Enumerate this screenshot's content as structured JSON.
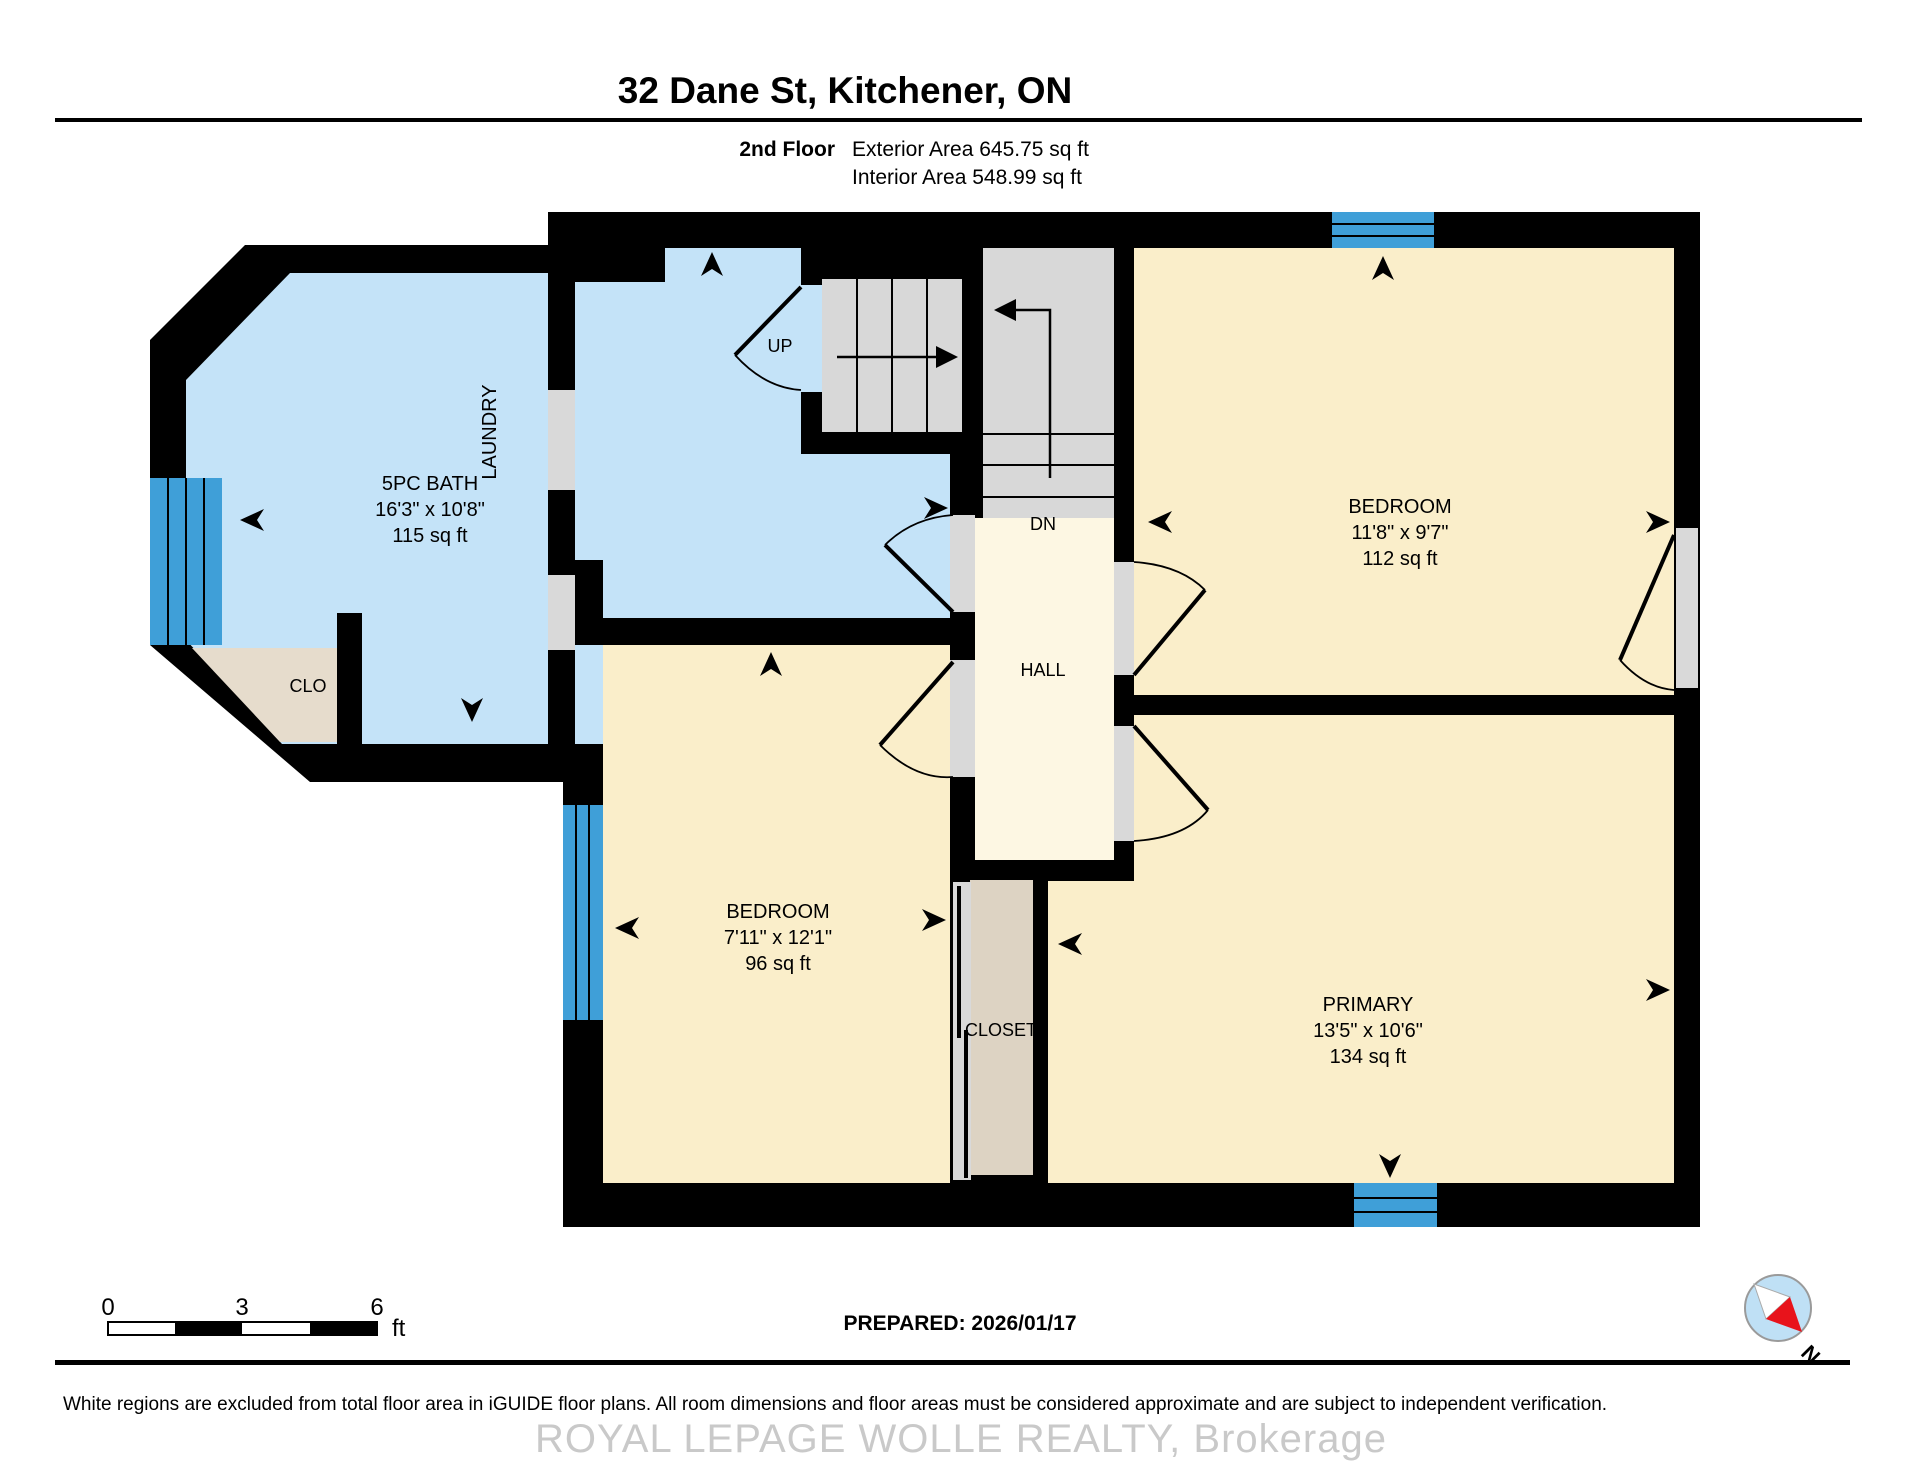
{
  "header": {
    "title": "32 Dane St, Kitchener, ON",
    "floor_label": "2nd Floor",
    "exterior_area": "Exterior Area 645.75 sq ft",
    "interior_area": "Interior Area 548.99 sq ft"
  },
  "rooms": {
    "bath": {
      "name": "5PC BATH",
      "dims": "16'3\" x 10'8\"",
      "area": "115 sq ft"
    },
    "laundry": {
      "name": "LAUNDRY"
    },
    "bedroom_top": {
      "name": "BEDROOM",
      "dims": "11'8\" x 9'7\"",
      "area": "112 sq ft"
    },
    "bedroom_left": {
      "name": "BEDROOM",
      "dims": "7'11\" x 12'1\"",
      "area": "96 sq ft"
    },
    "primary": {
      "name": "PRIMARY",
      "dims": "13'5\" x 10'6\"",
      "area": "134 sq ft"
    },
    "hall": {
      "name": "HALL"
    },
    "closet": {
      "name": "CLOSET"
    },
    "clo": {
      "name": "CLO"
    },
    "stairs": {
      "up": "UP",
      "down": "DN"
    }
  },
  "scale_bar": {
    "labels": [
      "0",
      "3",
      "6"
    ],
    "unit": "ft"
  },
  "compass": {
    "label": "N"
  },
  "footer": {
    "prepared": "PREPARED: 2026/01/17",
    "disclaimer": "White regions are excluded from total floor area in iGUIDE floor plans. All room dimensions and floor areas must be considered approximate and are subject to independent verification.",
    "watermark": "ROYAL LEPAGE WOLLE REALTY, Brokerage"
  },
  "colors": {
    "wall": "#000000",
    "floor_blue": "#c4e3f8",
    "floor_cream": "#faeeca",
    "hall_cream": "#fdf7e3",
    "stair_gray": "#d8d8d8",
    "opening_gray": "#d9d9d9",
    "closet_tan": "#ddd3c3",
    "clo_tan": "#e6dccc",
    "window_blue": "#3f9fd8",
    "compass_blue": "#bfe0f5",
    "compass_red": "#e8131b",
    "watermark_gray": "#c9c9c9"
  }
}
